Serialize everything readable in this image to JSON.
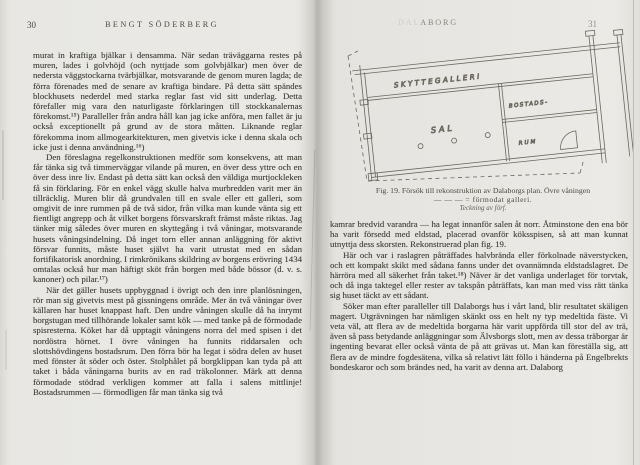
{
  "scan": {
    "left_page": {
      "page_number": "30",
      "running_head": "BENGT SÖDERBERG",
      "paragraphs": [
        {
          "text": "murat in kraftiga bjälkar i densamma. När sedan träväggarna restes på muren, lades i golvhöjd (och nyttjade som golvbjälkar) men över de nedersta väggstockarna tvärbjälkar, motsvarande de genom muren lagda; de förra förenades med de senare av kraftiga bindare. På detta sätt spändes blockhusets nederdel med starka reglar fast vid sitt underlag. Detta förefaller mig vara den naturligaste förklaringen till stockkanalernas förekomst.¹⁵) Paralleller från andra håll kan jag icke anföra, men fallet är ju också exceptionellt på grund av de stora måtten. Liknande reglar förekomma inom allmogearkitekturen, men givetvis icke i denna skala och icke just i denna användning.¹⁶)"
        },
        {
          "text": "Den föreslagna regelkonstruktionen medför som konsekvens, att man får tänka sig två timmerväggar vilande på muren, en över dess yttre och en över dess inre liv. Endast på detta sätt kan också den väldiga murtjockleken få sin förklaring. För en enkel vägg skulle halva murbredden varit mer än tillräcklig. Muren blir då grundvalen till en svale eller ett galleri, som omgivit de inre rummen på de två sidor, från vilka man kunde vänta sig ett fientligt angrepp och åt vilket borgens försvarskraft främst måste riktas. Jag tänker mig således över muren en skyttegång i två våningar, motsvarande husets våningsindelning. Då inget torn eller annan anläggning för aktivt försvar funnits, måste huset självt ha varit utrustat med en sådan fortifikatorisk anordning. I rimkrönikans skildring av borgens erövring 1434 omtalas också hur man häftigt sköt från borgen med både bössor (d. v. s. kanoner) och pilar.¹⁷)"
        },
        {
          "text": "När det gäller husets uppbyggnad i övrigt och den inre planlösningen, rör man sig givetvis mest på gissningens område. Mer än två våningar över källaren har huset knappast haft. Den undre våningen skulle då ha inrymt borgstugan med tillhörande lokaler samt kök — med tanke på de förmodade spisresterna. Köket har då upptagit våningens norra del med spisen i det nordöstra hörnet. I övre våningen ha funnits riddarsalen och slottshövdingens bostadsrum. Den förra bör ha legat i södra delen av huset med fönster åt söder och öster. Stolphålet på borgklippan kan tyda på att taket i båda våningarna burits av en rad träkolonner. Märk att denna förmodade stödrad verkligen kommer att falla i salens mittlinje! Bostadsrummen — förmodligen får man tänka sig två"
        }
      ]
    },
    "right_page": {
      "page_number": "31",
      "running_head": {
        "faded_part": "DAL",
        "visible_part": "ABORG"
      },
      "figure": {
        "labels": {
          "gallery": "SKYTTEGALLERI",
          "hall": "SAL",
          "room_upper": "BOSTADS-",
          "room_lower": "RUM"
        },
        "caption": {
          "line1": "Fig. 19.  Försök till rekonstruktion av Dalaborgs plan.  Övre våningen",
          "line2": "— — — = förmodat galleri.",
          "line3": "Teckning av förf."
        }
      },
      "paragraphs": [
        {
          "text": "kamrar bredvid varandra — ha legat innanför salen åt norr. Åtminstone den ena bör ha varit försedd med eldstad, placerad ovanför köksspisen, så att man kunnat utnyttja dess skorsten. Rekonstruerad plan fig. 19."
        },
        {
          "text": "Här och var i raslagren påträffades halvbrända eller förkolnade näverstycken, och ett kompakt skikt med sådana fanns under det ovannämnda eldstadslagret. De härröra med all säkerhet från taket.¹⁸) Näver är det vanliga underlaget för torvtak, och då inga taktegel eller rester av takspån påträffats, kan man med viss rätt tänka sig huset täckt av ett sådant."
        },
        {
          "text": "Söker man efter paralleller till Dalaborgs hus i vårt land, blir resultatet skäligen magert. Utgrävningen har nämligen skänkt oss en helt ny typ medeltida fäste. Vi veta väl, att flera av de medeltida borgarna här varit uppförda till stor del av trä, även så pass betydande anläggningar som Älvsborgs slott, men av dessa träborgar är ingenting bevarat eller också vänta de på att grävas ut. Man kan föreställa sig, att flera av de mindre fogdesätena, vilka så relativt lätt föllo i händerna på Engelbrekts bondeskaror och som brändes ned, ha varit av denna art. Dalaborg"
        }
      ]
    }
  }
}
